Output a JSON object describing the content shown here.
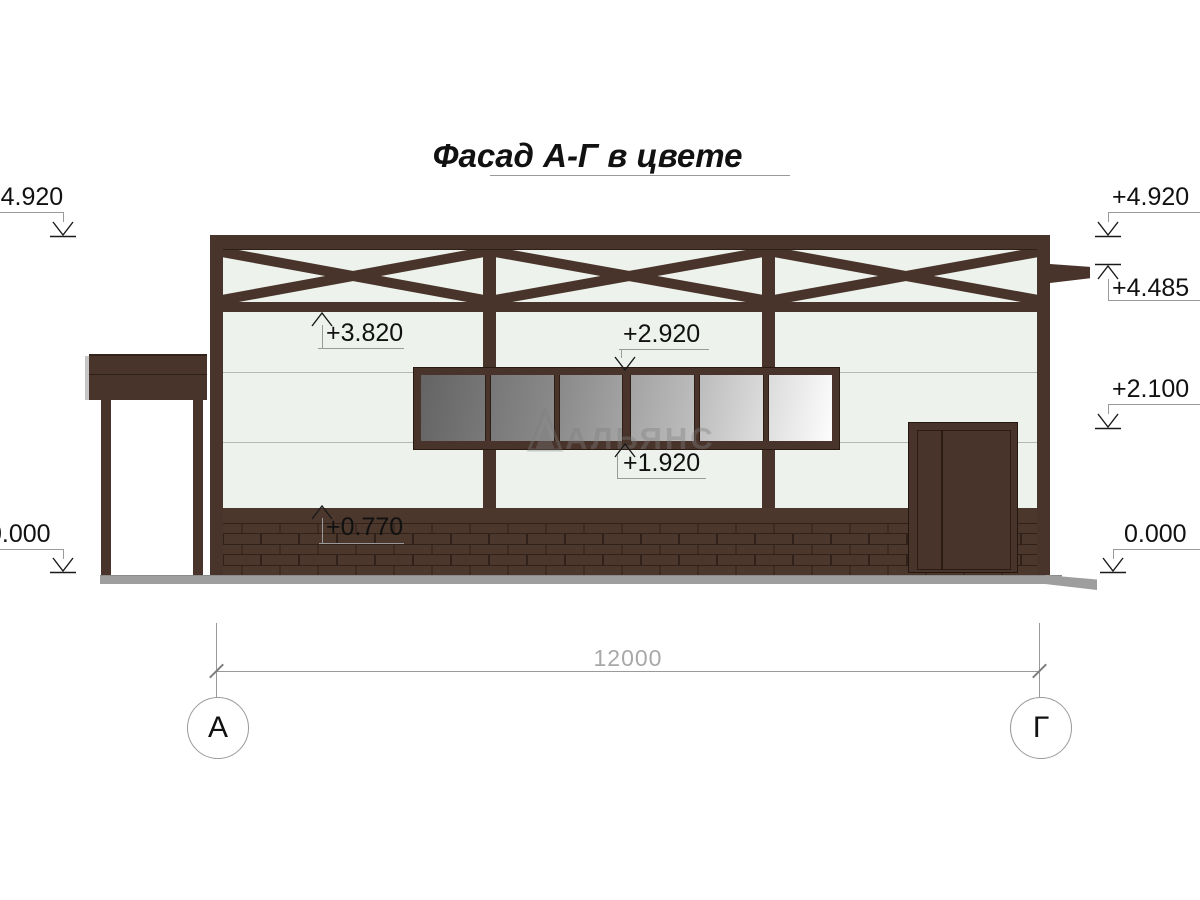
{
  "title": {
    "text": "Фасад А-Г в цвете"
  },
  "watermark": {
    "text": "АЛЬЯНС"
  },
  "elevations": {
    "left_top": "+4.920",
    "left_ground": "0.000",
    "right_top": "+4.920",
    "right_beam": "+4.485",
    "right_lintel": "+2.100",
    "right_ground": "0.000",
    "truss_bottom": "+3.820",
    "window_head": "+2.920",
    "window_sill": "+1.920",
    "plinth_top": "+0.770"
  },
  "dimension": {
    "span": "12000"
  },
  "axes": {
    "left": "А",
    "right": "Г"
  },
  "colors": {
    "frame_brown": "#49342b",
    "wall_green_white": "#edf3ec",
    "brick": "#4b372b",
    "mortar": "#30221a",
    "ground_gray": "#9e9e9e",
    "glass_dark": "#646464",
    "glass_light": "#fdfdfd",
    "leader_gray": "#9a9a9a"
  }
}
